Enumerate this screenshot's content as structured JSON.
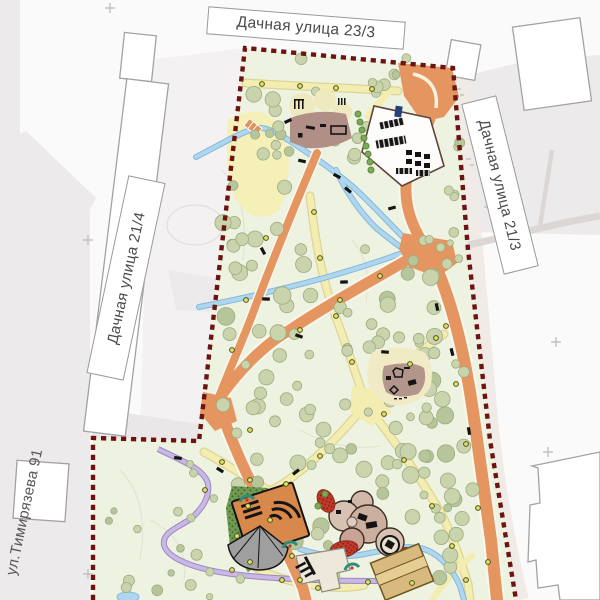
{
  "map": {
    "title": "park landscaping site plan",
    "street_labels": [
      {
        "id": "street-top",
        "text": "Дачная улица 23/3"
      },
      {
        "id": "street-left",
        "text": "Дачная улица 21/4"
      },
      {
        "id": "street-right",
        "text": "Дачная улица 21/3"
      },
      {
        "id": "street-bottom-left",
        "text": "ул.Тимирязева 91"
      }
    ],
    "colors": {
      "background": "#fbfafa",
      "outside_blocks": "#eceaea",
      "park_fill": "#eef2e0",
      "project_boundary": "#6d1410",
      "main_path": "#e5955f",
      "secondary_path": "#f3edb2",
      "minor_path": "#c0aede",
      "water": "#aed6ef",
      "tree": "#c9d3ac",
      "dense_planting": "#6f9b52",
      "playground_surface": "#b09086",
      "label_text": "#4a4a4a"
    }
  }
}
